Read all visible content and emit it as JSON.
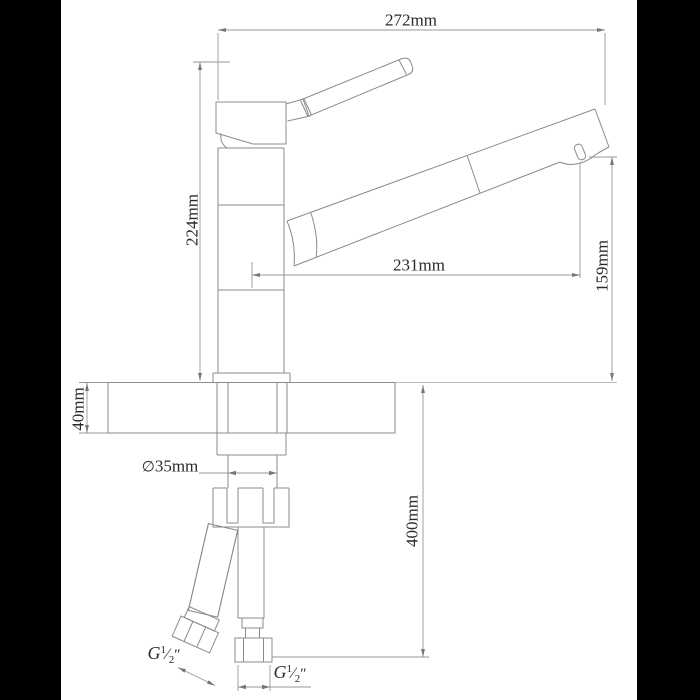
{
  "drawing": {
    "labels": {
      "overall_width": "272mm",
      "total_height": "224mm",
      "spout_reach": "231mm",
      "spout_outlet_height": "159mm",
      "mount_thickness": "40mm",
      "hole_diameter_symbol": "∅",
      "hole_diameter_value": "35mm",
      "hose_drop": "400mm"
    },
    "thread_label": {
      "prefix": "G",
      "numerator": "1",
      "fraction_slash": "⁄",
      "denominator": "2",
      "inch_mark": "″"
    },
    "colors": {
      "background": "#ffffff",
      "pillarbox": "#000000",
      "line": "#8b8b8b",
      "text": "#2a2a2a"
    }
  }
}
